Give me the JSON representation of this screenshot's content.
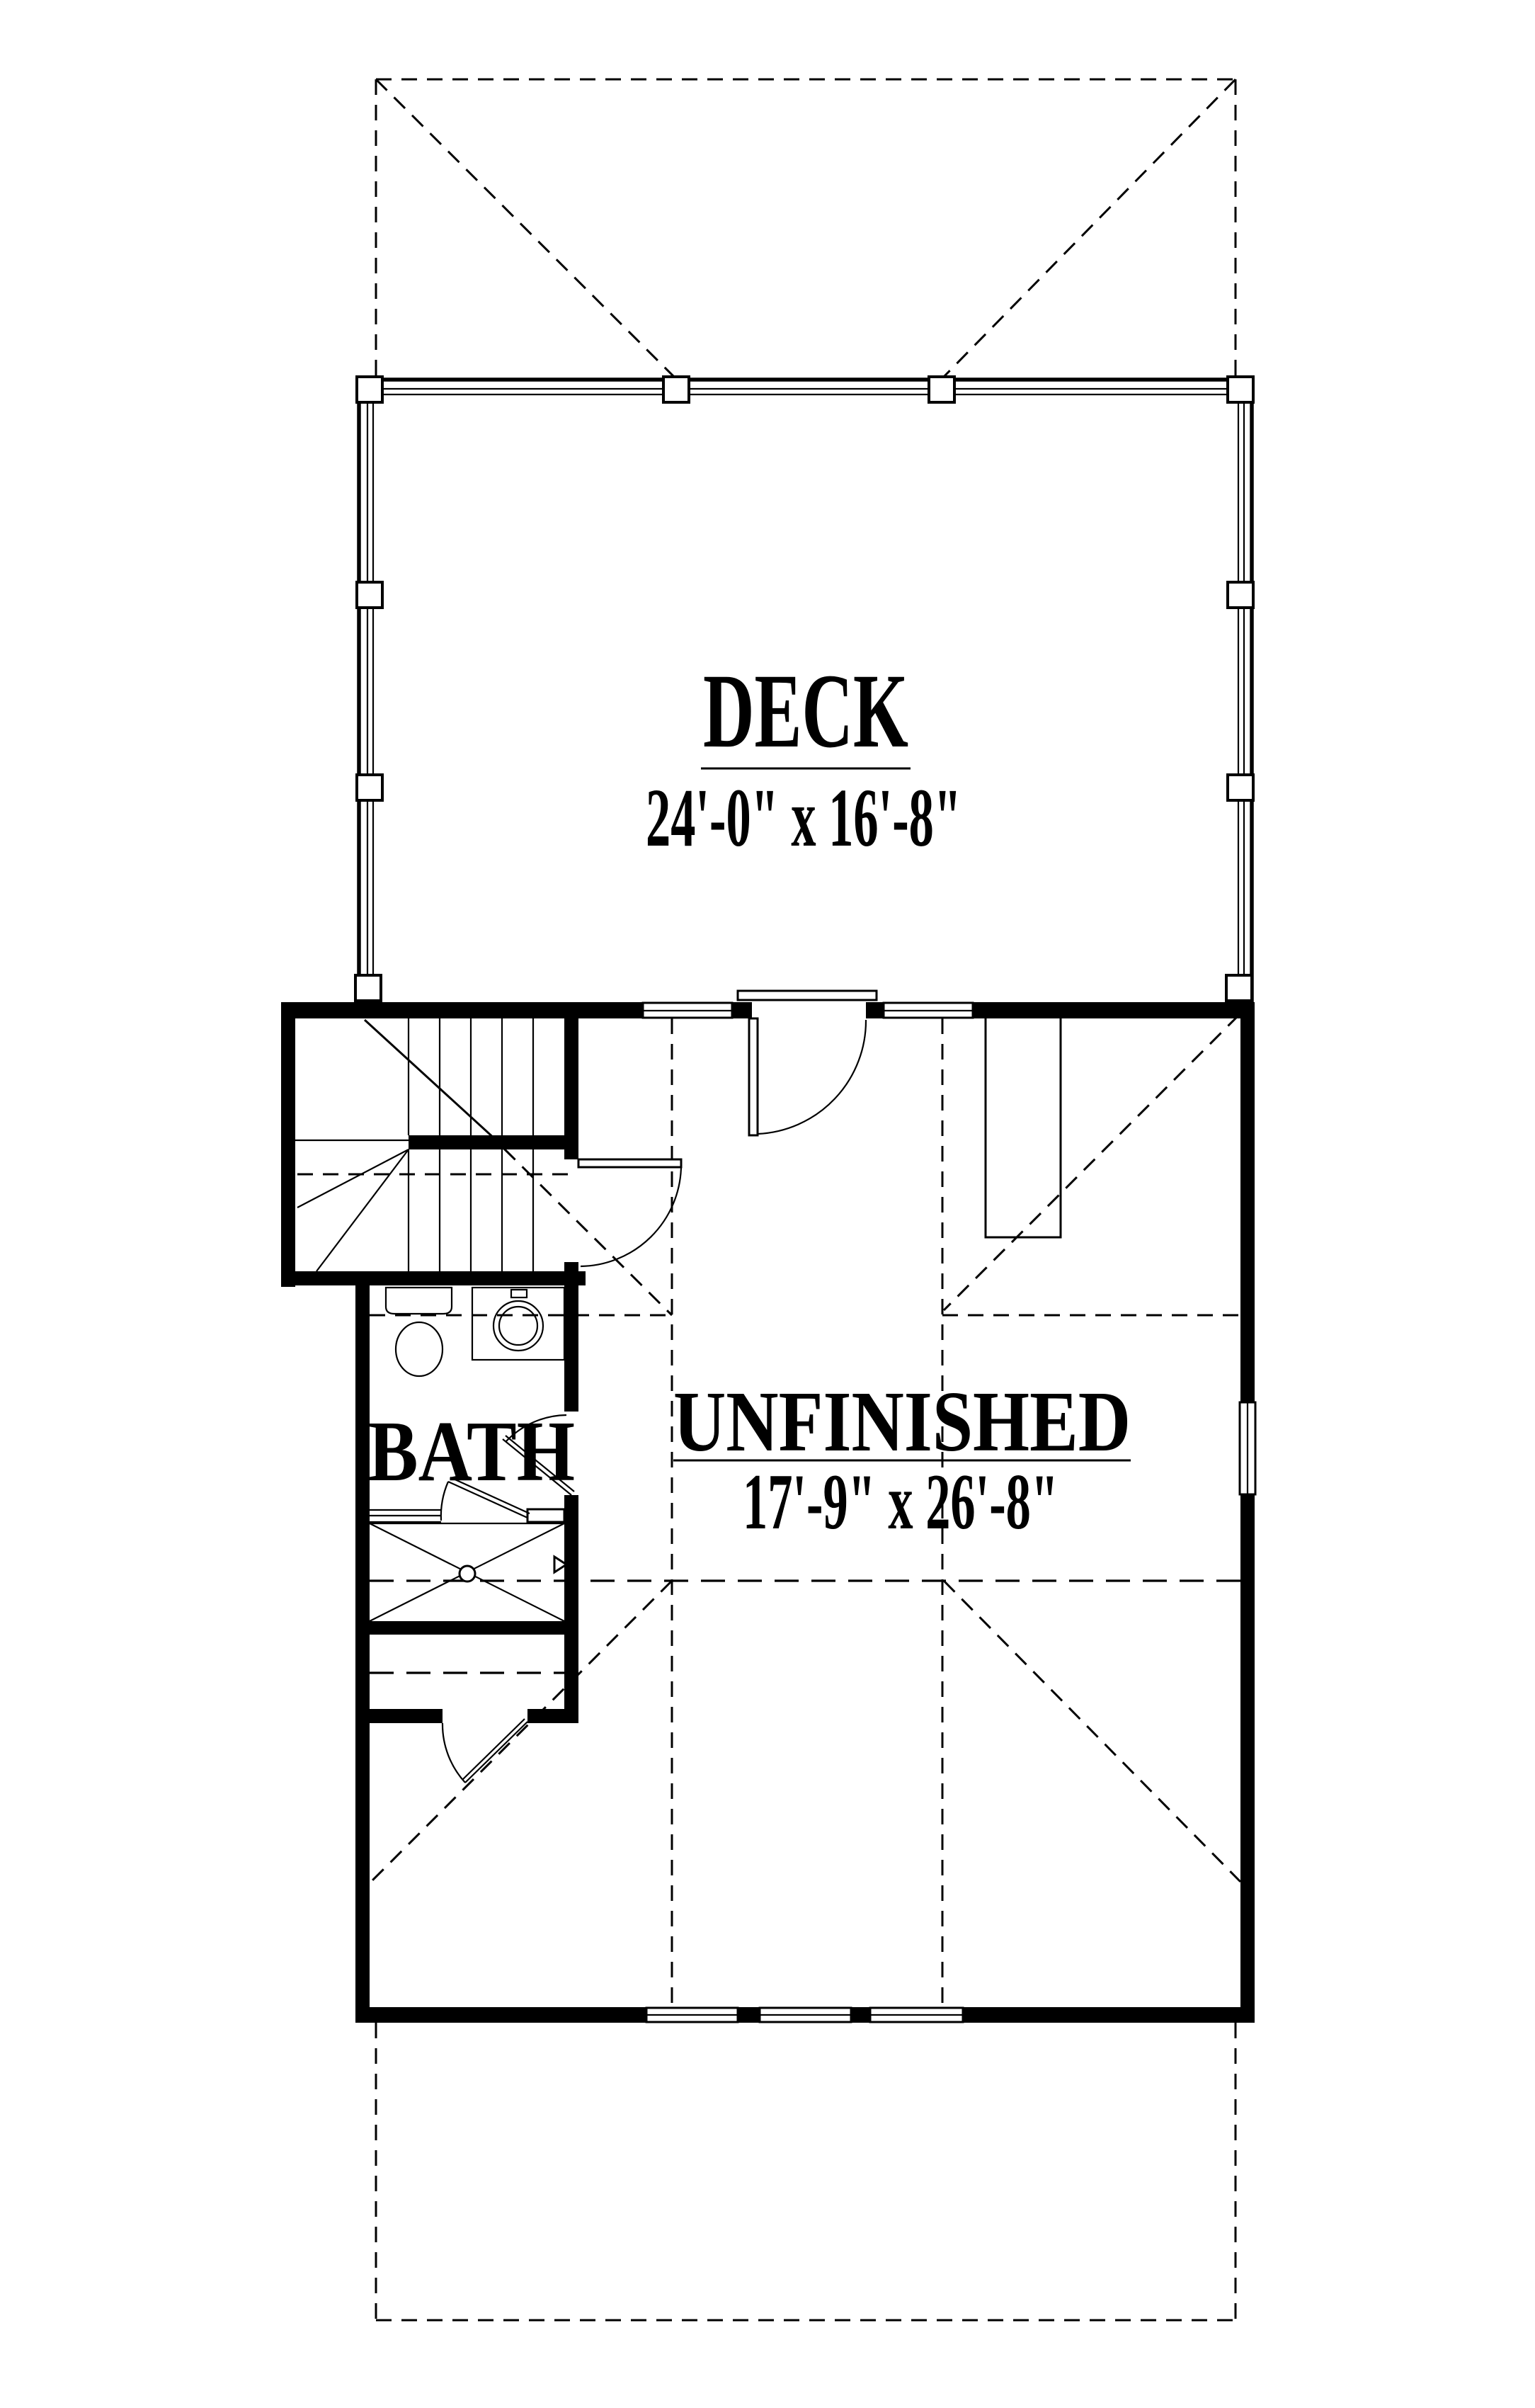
{
  "drawing": {
    "type": "floor-plan",
    "colors": {
      "ink": "#000000",
      "paper": "#ffffff"
    }
  },
  "rooms": {
    "deck": {
      "label": "DECK",
      "dims": "24'-0\" x 16'-8\""
    },
    "unfinished": {
      "label": "UNFINISHED",
      "dims": "17'-9\" x 26'-8\""
    },
    "bath": {
      "label": "BATH"
    }
  }
}
